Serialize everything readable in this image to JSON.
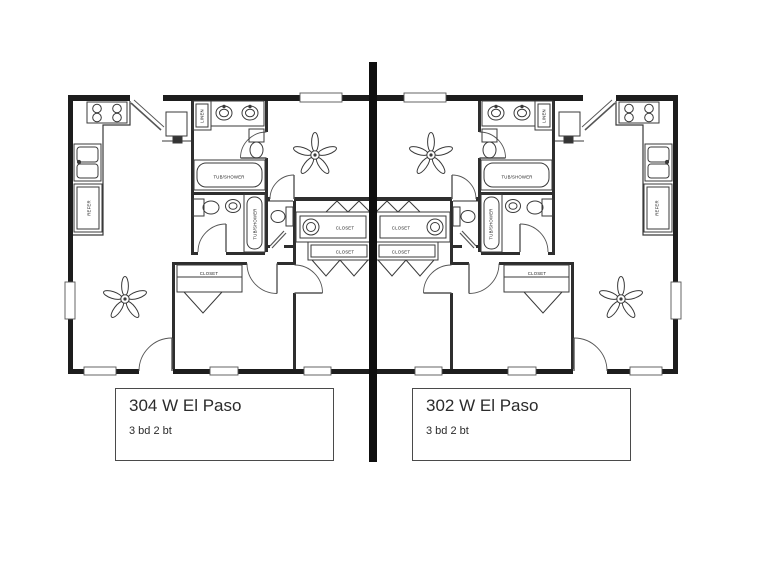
{
  "page": {
    "background": "#ffffff"
  },
  "divider": {
    "color": "#0f0f0f"
  },
  "plan": {
    "ink": "#222222",
    "wall": "#1d1d1d",
    "units": [
      {
        "address": "304 W El Paso",
        "specs": "3 bd 2 bt",
        "labels": {
          "linen": "LINEN",
          "refer": "REFER",
          "tub_shower_master": "TUB/SHOWER",
          "tub_shower_hall": "TUB/SHOWER",
          "closet_hall": "CLOSET",
          "closet_bedroom2": "CLOSET",
          "closet_bedroom1": "CLOSET"
        }
      },
      {
        "address": "302 W El Paso",
        "specs": "3 bd 2 bt",
        "labels": {
          "linen": "LINEN",
          "refer": "REFER",
          "tub_shower_master": "TUB/SHOWER",
          "tub_shower_hall": "TUB/SHOWER",
          "closet_hall": "CLOSET",
          "closet_bedroom2": "CLOSET",
          "closet_bedroom1": "CLOSET"
        }
      }
    ]
  }
}
